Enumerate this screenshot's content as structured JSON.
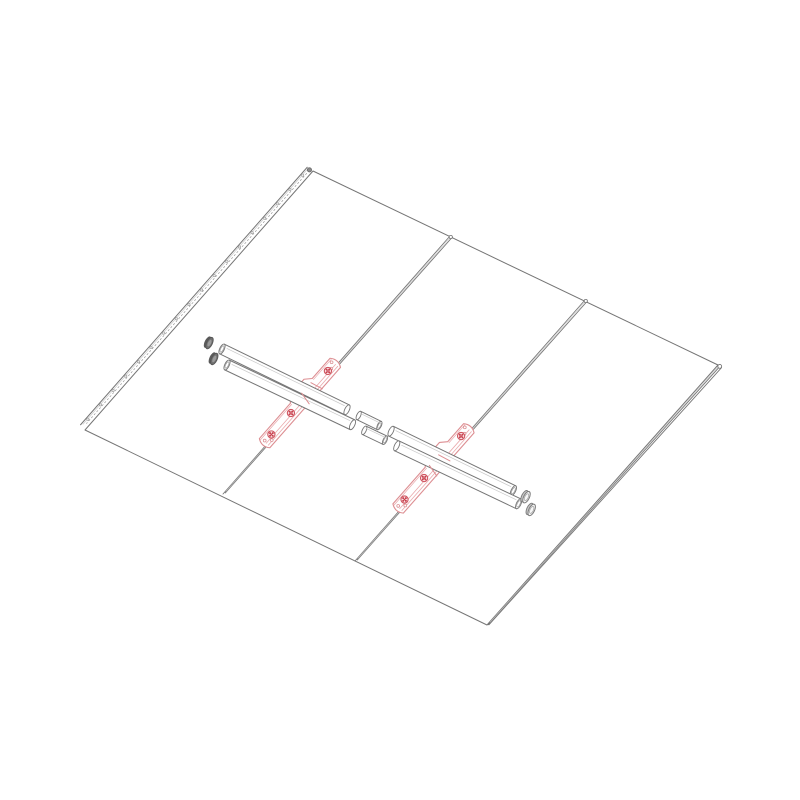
{
  "page": {
    "width": 800,
    "height": 800,
    "background": "#ffffff"
  },
  "drawing": {
    "name": "standing-seam-metal-roof-mount-exploded-assembly",
    "colors": {
      "line": "#757575",
      "line_light": "#9a9a9a",
      "highlight": "#c9c9c9",
      "panel": "#ffffff",
      "bracket": "#dd8e92",
      "bracket_light": "#eaa9ac",
      "screw_ring": "#cf5560",
      "screw_fill": "#c8404e",
      "screw_bg": "#fdf1f1",
      "hole": "#dc9296",
      "cap_dark": "#707070",
      "cap_dark_inner": "#9a9a9a",
      "cap_dark_stroke": "#555555",
      "cap_light": "#f7f7f7",
      "cap_light_side": "#c7c7c7",
      "cap_light_stroke": "#7a7a7a"
    },
    "roof": {
      "corners": {
        "top": [
          313,
          171
        ],
        "right": [
          718,
          365
        ],
        "bottom": [
          487,
          625
        ],
        "left": [
          85,
          430
        ]
      },
      "panel_count": 3
    },
    "left_edge_strip": {
      "outer_offset": -6.8,
      "mid_offset": -5.3,
      "dot_offset": -3.2,
      "hole_offset": -5.0,
      "hole_count": 18,
      "hole_r": 1.2,
      "end_nub_r": 2.1
    },
    "right_edge_rib": {
      "offsets": [
        2.4,
        4.6
      ],
      "light_offset": 1.2,
      "cap_r": 1.9
    },
    "seams": [
      {
        "name": "seam-1",
        "top": [
          450,
          236
        ],
        "bottom": [
          223,
          494
        ]
      },
      {
        "name": "seam-2",
        "top": [
          585,
          300
        ],
        "bottom": [
          355,
          561
        ]
      }
    ],
    "seam_rib": {
      "offset": 2.6,
      "light_offset": 1.3,
      "cap_r": 1.6
    },
    "pipes": [
      {
        "name": "pipe-upper",
        "start": [
          222,
          349
        ],
        "end": [
          514,
          491
        ],
        "radius": 5.4,
        "segments": [
          [
            0,
            139
          ],
          [
            188,
            324
          ]
        ],
        "coupler": [
          152,
          175
        ],
        "coupler_radius": 4.6,
        "caps": {
          "left": [
            209.5,
            343.1
          ],
          "right": [
            526.5,
            497.2
          ]
        }
      },
      {
        "name": "pipe-lower",
        "start": [
          227,
          365
        ],
        "end": [
          519,
          504
        ],
        "radius": 5.4,
        "segments": [
          [
            0,
            139
          ],
          [
            188,
            323
          ]
        ],
        "coupler": [
          152,
          175
        ],
        "coupler_radius": 4.6,
        "caps": {
          "left": [
            214.3,
            359.0
          ],
          "right": [
            531.7,
            509.9
          ]
        }
      }
    ],
    "cap": {
      "radius": 6.2,
      "half_len": 2.2
    },
    "band": {
      "far_offset": -9.3,
      "near_offset": 4.6,
      "bump_top": -15,
      "bump_margin": 11,
      "bump_shoulder": 5
    },
    "brackets": [
      {
        "name": "bracket-left",
        "seam": 0,
        "span": [
          168,
          281
        ],
        "clamp": "upper",
        "crossings": {
          "upper": 209,
          "lower": 220
        },
        "screws": [
          {
            "s": 182,
            "o": -2.5
          },
          {
            "s": 238,
            "o": -2.5
          },
          {
            "s": 267,
            "o": -3
          }
        ],
        "holes": [
          {
            "s": 173,
            "o": -5.5
          },
          {
            "s": 178,
            "o": -1.5
          },
          {
            "s": 271,
            "o": 1
          },
          {
            "s": 276,
            "o": -4
          }
        ]
      },
      {
        "name": "bracket-right",
        "seam": 1,
        "span": [
          170,
          283
        ],
        "clamp": "lower",
        "crossings": {
          "upper": 208,
          "lower": 220
        },
        "screws": [
          {
            "s": 184,
            "o": -3
          },
          {
            "s": 240,
            "o": -3
          },
          {
            "s": 269,
            "o": -3.5
          }
        ],
        "holes": [
          {
            "s": 175,
            "o": -6
          },
          {
            "s": 180,
            "o": -2
          },
          {
            "s": 273,
            "o": 1
          },
          {
            "s": 278,
            "o": -4
          }
        ]
      }
    ]
  }
}
